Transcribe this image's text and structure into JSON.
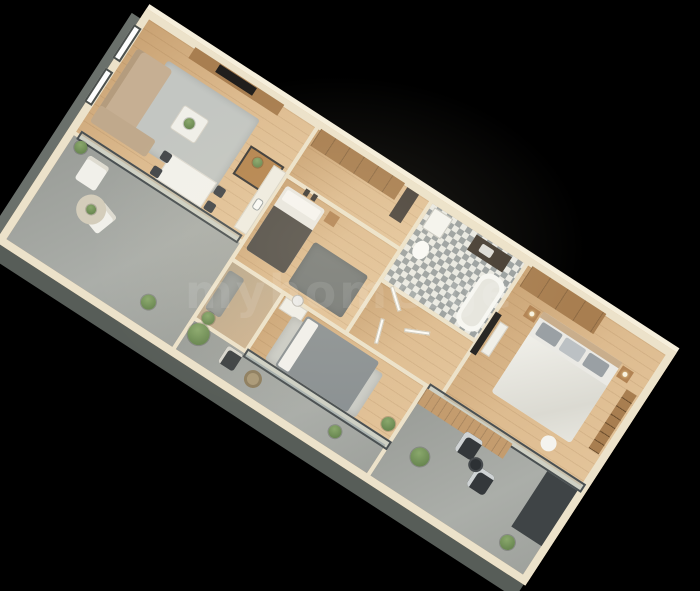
{
  "watermark": {
    "text": "myhome.ge"
  },
  "scene": {
    "description": "3D isometric rendering of an apartment floor plan on a black background",
    "background_color": "#000000",
    "rotation_deg": 33,
    "palette": {
      "wood_floor": "#d7b287",
      "wall_top": "#ece2ca",
      "wall_face": "#575d58",
      "balcony_concrete": "#a3a6a1",
      "bath_tile_dark": "#9aa0a0",
      "bath_tile_light": "#e9e9e3",
      "wardrobe_wood": "#a87e50",
      "sofa_beige": "#c6af93",
      "bed_white": "#eae9e4",
      "bed_gray": "#8b9193",
      "blanket_dark": "#534f49",
      "plant_green": "#6f8f5a",
      "tv_black": "#23211f",
      "glass_frame": "#4a5052"
    },
    "rooms": [
      {
        "id": "living-room",
        "label": "Living room",
        "floor": "wood",
        "furniture": [
          "sofa",
          "area-rug",
          "coffee-table-with-plant",
          "tv-wall-unit",
          "console-table",
          "dining-table",
          "four-dining-chairs",
          "two-windows",
          "kitchen-counter-with-sink"
        ]
      },
      {
        "id": "entry-hall",
        "label": "Entry hall",
        "floor": "wood",
        "furniture": [
          "wooden-wardrobe",
          "dark-entry-door"
        ]
      },
      {
        "id": "small-bedroom",
        "label": "Small bedroom",
        "floor": "wood",
        "furniture": [
          "single-bed-dark-blanket",
          "nightstand",
          "dark-gray-rug",
          "wall-frames"
        ]
      },
      {
        "id": "bathroom",
        "label": "Bathroom",
        "floor": "triangle-mosaic-tile",
        "furniture": [
          "bathtub",
          "dark-vanity-with-sink",
          "washing-machine",
          "toilet"
        ]
      },
      {
        "id": "hallway",
        "label": "Hallway",
        "floor": "wood",
        "furniture": [
          "three-open-doors"
        ]
      },
      {
        "id": "master-bedroom",
        "label": "Master bedroom",
        "floor": "wood",
        "furniture": [
          "double-bed-white",
          "wooden-wardrobe",
          "two-nightstands-with-lamps",
          "bookshelf",
          "wall-tv-with-console",
          "round-chair"
        ]
      },
      {
        "id": "bedroom-2",
        "label": "Second bedroom",
        "floor": "wood",
        "furniture": [
          "double-bed-gray",
          "light-rug",
          "vanity-with-round-mirror",
          "plant"
        ]
      },
      {
        "id": "corridor",
        "label": "Corridor",
        "floor": "wood",
        "furniture": [
          "runner-rug",
          "plant"
        ]
      },
      {
        "id": "balcony-left",
        "label": "Left balcony",
        "floor": "concrete",
        "furniture": [
          "two-white-lounge-chairs",
          "round-rug-with-plant",
          "plants",
          "glass-sliding-doors"
        ]
      },
      {
        "id": "balcony-bottom",
        "label": "Bottom balcony",
        "floor": "concrete",
        "furniture": [
          "dark-armchair",
          "woven-pouf",
          "plants"
        ]
      },
      {
        "id": "balcony-right",
        "label": "Right balcony",
        "floor": "concrete",
        "furniture": [
          "two-wicker-chairs",
          "round-side-table",
          "wood-deck-strip",
          "dark-floor-mat",
          "plants",
          "glass-sliding-doors"
        ]
      }
    ]
  }
}
